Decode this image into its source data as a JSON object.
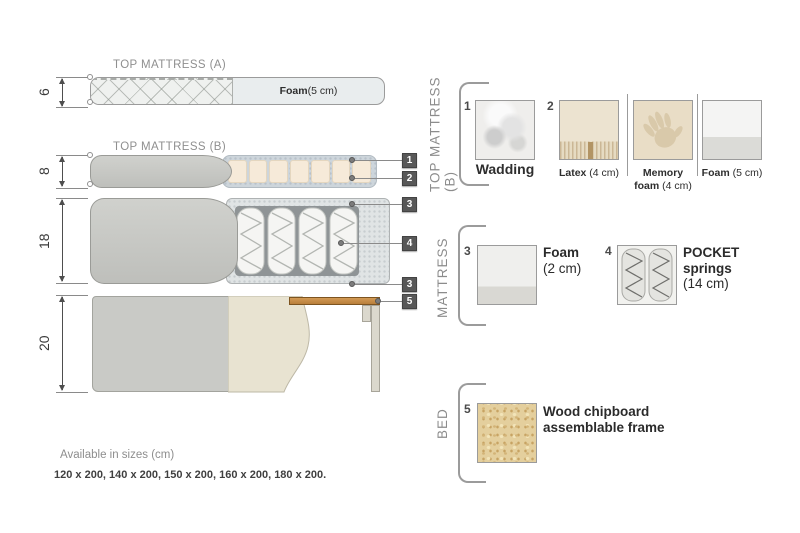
{
  "diagram": {
    "dims": [
      {
        "value": "6"
      },
      {
        "value": "8"
      },
      {
        "value": "18"
      },
      {
        "value": "20"
      }
    ],
    "top_a": {
      "title": "TOP MATTRESS (A)",
      "foam_bold": "Foam",
      "foam_rest": " (5 cm)"
    },
    "top_b": {
      "title": "TOP MATTRESS (B)"
    },
    "callouts": [
      {
        "n": "1"
      },
      {
        "n": "2"
      },
      {
        "n": "3"
      },
      {
        "n": "4"
      },
      {
        "n": "3"
      },
      {
        "n": "5"
      }
    ]
  },
  "panel": {
    "top": {
      "label": "TOP MATTRESS (B)",
      "wadding": {
        "num": "1",
        "name": "Wadding"
      },
      "latex": {
        "num": "2",
        "name": "Latex",
        "detail": " (4 cm)"
      },
      "memory": {
        "name_line1": "Memory",
        "name_line2": "foam",
        "detail": " (4 cm)"
      },
      "foam": {
        "name": "Foam",
        "detail": " (5 cm)"
      }
    },
    "middle": {
      "label": "MATTRESS",
      "foam": {
        "num": "3",
        "name": "Foam",
        "detail": "(2 cm)"
      },
      "springs": {
        "num": "4",
        "line1": "POCKET",
        "line2": "springs",
        "detail": "(14 cm)"
      }
    },
    "bottom": {
      "label": "BED",
      "wood": {
        "num": "5",
        "line1": "Wood chipboard",
        "line2": "assemblable frame"
      }
    }
  },
  "footer": {
    "line1": "Available in sizes (cm)",
    "line2": "120 x 200, 140 x 200, 150 x 200, 160 x 200, 180 x 200."
  },
  "colors": {
    "fabric_grey": "#c8c9c5",
    "latex_beige": "#f6ead9",
    "wadding_blue_grey": "#cdd5db",
    "wood_slat": "#c18a4a",
    "wood_chipboard": "#e4cf9d",
    "callout_badge": "#585858",
    "label_grey": "#8c8c8c"
  }
}
